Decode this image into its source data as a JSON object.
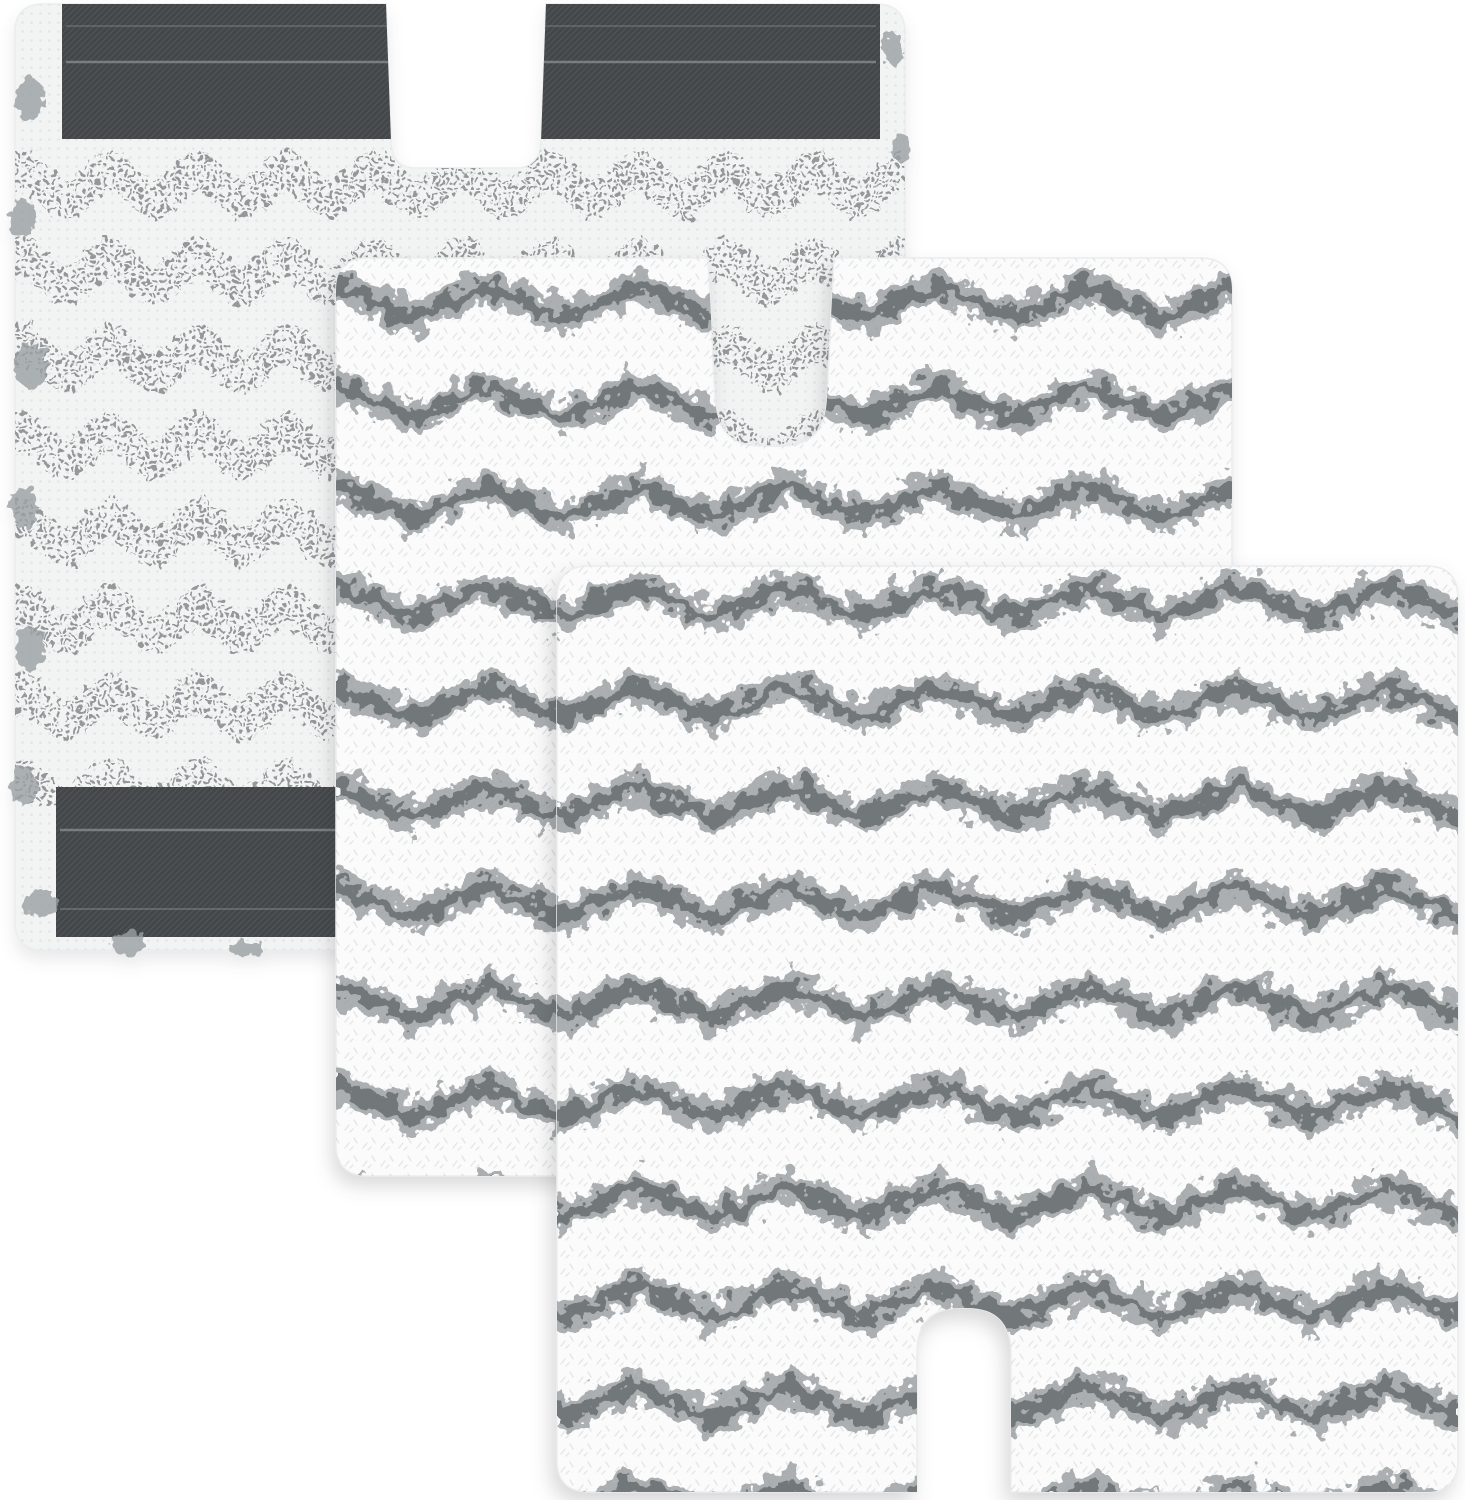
{
  "scene": {
    "kind": "product-photo",
    "subject": "3 chevron microfiber steam-mop replacement pads on a white background",
    "pad_count": 3,
    "pads": [
      {
        "id": "back-pad",
        "position": "top-left",
        "side_shown": "back (attachment side)",
        "texture": "white mesh with dotted gray chevron stripes and frayed fringe edges",
        "attachment_strips": 2,
        "notch": "top-center"
      },
      {
        "id": "middle-pad",
        "position": "center",
        "side_shown": "front (cleaning side)",
        "texture": "white plush fluff with gray zigzag chevron stripes",
        "attachment_strips": 0,
        "notch": "top-center"
      },
      {
        "id": "front-pad",
        "position": "bottom-right",
        "side_shown": "front (cleaning side)",
        "texture": "white plush fluff with gray zigzag chevron stripes",
        "attachment_strips": 0,
        "notch": "bottom-center"
      }
    ]
  },
  "colors": {
    "background": "#ffffff",
    "velcro": "#43474a",
    "velcro_hl": "#73777a",
    "velcro_seam": "#9aa0a3",
    "mesh_base": "#f2f3f3",
    "mesh_dot": "#8f9396",
    "mesh_fine_dot": "#e1e3e4",
    "fluff_base": "#fbfbfb",
    "stripe": "#979c9f",
    "stripe_dark": "#686d70",
    "fringe": "#9aa0a3",
    "grain": "#ccd0d2",
    "edge": "#ebedee"
  }
}
